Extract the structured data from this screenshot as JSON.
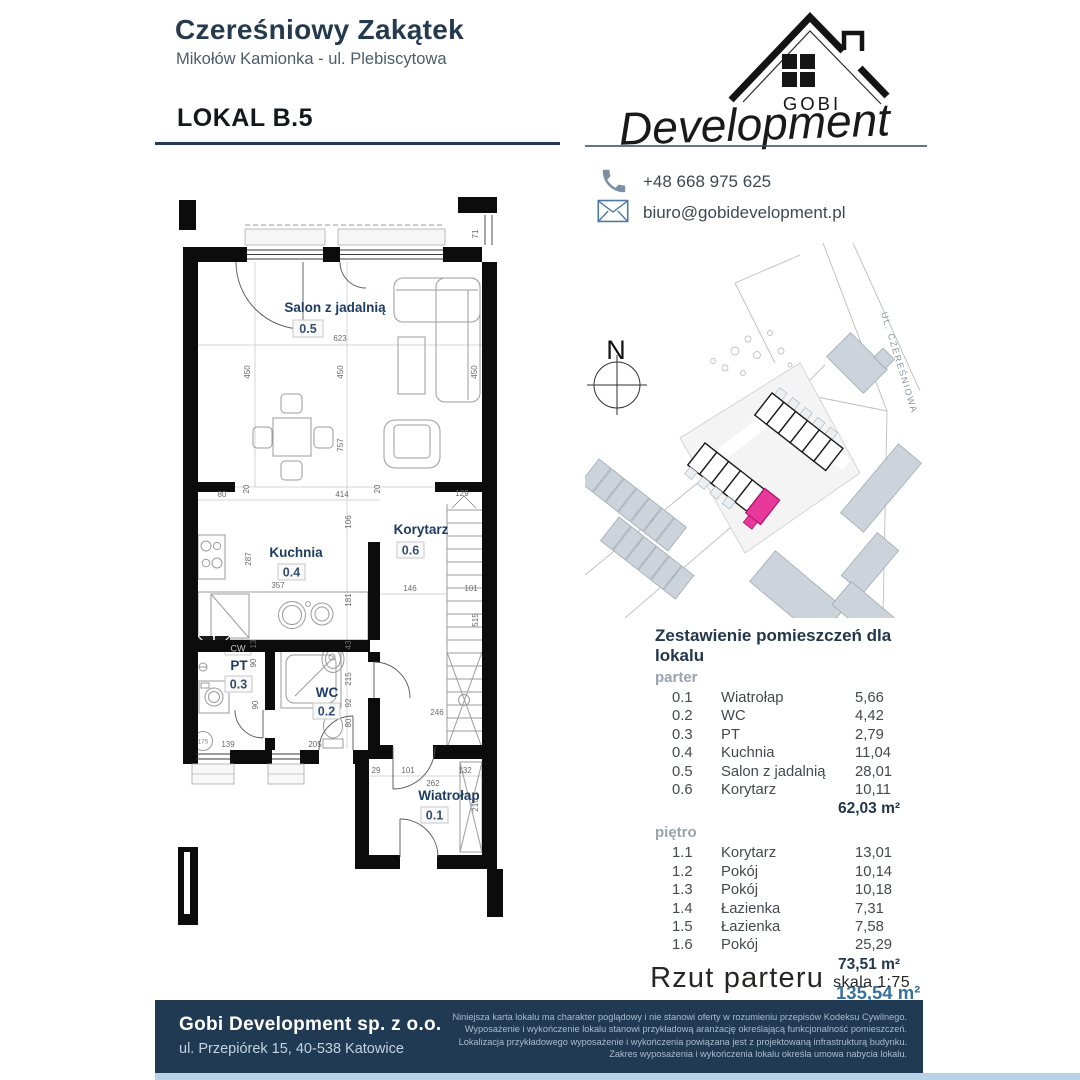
{
  "header": {
    "title": "Czereśniowy Zakątek",
    "subtitle": "Mikołów Kamionka - ul. Plebiscytowa",
    "unit_label": "LOKAL B.5"
  },
  "logo": {
    "name": "GOBI",
    "script": "Development"
  },
  "contact": {
    "phone": "+48 668 975 625",
    "email": "biuro@gobidevelopment.pl"
  },
  "floor_plan": {
    "rooms": [
      {
        "name": "Salon z jadalnią",
        "id": "0.5"
      },
      {
        "name": "Kuchnia",
        "id": "0.4"
      },
      {
        "name": "Korytarz",
        "id": "0.6"
      },
      {
        "name": "PT",
        "id": "0.3"
      },
      {
        "name": "WC",
        "id": "0.2"
      },
      {
        "name": "Wiatrołap",
        "id": "0.1"
      }
    ],
    "dims": [
      "71",
      "623",
      "450",
      "450",
      "450",
      "757",
      "20",
      "20",
      "80",
      "414",
      "129",
      "106",
      "287",
      "181",
      "357",
      "146",
      "101",
      "515",
      "43",
      "215",
      "92",
      "13",
      "90",
      "90",
      "139",
      "205",
      "80",
      "246",
      "29",
      "101",
      "132",
      "262",
      "216",
      "175",
      "CW"
    ]
  },
  "site_map": {
    "compass": "N",
    "street": "UL. CZEREŚNIOWA"
  },
  "room_table": {
    "title": "Zestawienie pomieszczeń dla lokalu",
    "sections": [
      {
        "label": "parter",
        "rows": [
          [
            "0.1",
            "Wiatrołap",
            "5,66"
          ],
          [
            "0.2",
            "WC",
            "4,42"
          ],
          [
            "0.3",
            "PT",
            "2,79"
          ],
          [
            "0.4",
            "Kuchnia",
            "11,04"
          ],
          [
            "0.5",
            "Salon z jadalnią",
            "28,01"
          ],
          [
            "0.6",
            "Korytarz",
            "10,11"
          ]
        ],
        "total": "62,03 m²"
      },
      {
        "label": "piętro",
        "rows": [
          [
            "1.1",
            "Korytarz",
            "13,01"
          ],
          [
            "1.2",
            "Pokój",
            "10,14"
          ],
          [
            "1.3",
            "Pokój",
            "10,18"
          ],
          [
            "1.4",
            "Łazienka",
            "7,31"
          ],
          [
            "1.5",
            "Łazienka",
            "7,58"
          ],
          [
            "1.6",
            "Pokój",
            "25,29"
          ]
        ],
        "total": "73,51 m²"
      }
    ],
    "grand_total": "135,54 m²"
  },
  "plan_caption": {
    "title": "Rzut parteru",
    "scale": "skala 1:75"
  },
  "footer": {
    "company": "Gobi Development sp. z o.o.",
    "address": "ul. Przepiórek 15, 40-538 Katowice",
    "disclaimer": [
      "Niniejsza karta lokalu ma charakter poglądowy i nie stanowi oferty w rozumieniu przepisów Kodeksu Cywilnego.",
      "Wyposażenie i wykończenie lokalu stanowi przykładową aranżację określającą funkcjonalność pomieszczeń.",
      "Lokalizacja przykładowego wyposażenie i wykończenia powiązana jest z projektowaną infrastrukturą budynku.",
      "Zakres wyposażenia i wykończenia lokalu określa umowa nabycia lokalu."
    ]
  },
  "colors": {
    "navy": "#203a54",
    "accent_blue": "#38719f",
    "highlight_unit": "#e8399a",
    "strip": "#b7d2e7"
  }
}
